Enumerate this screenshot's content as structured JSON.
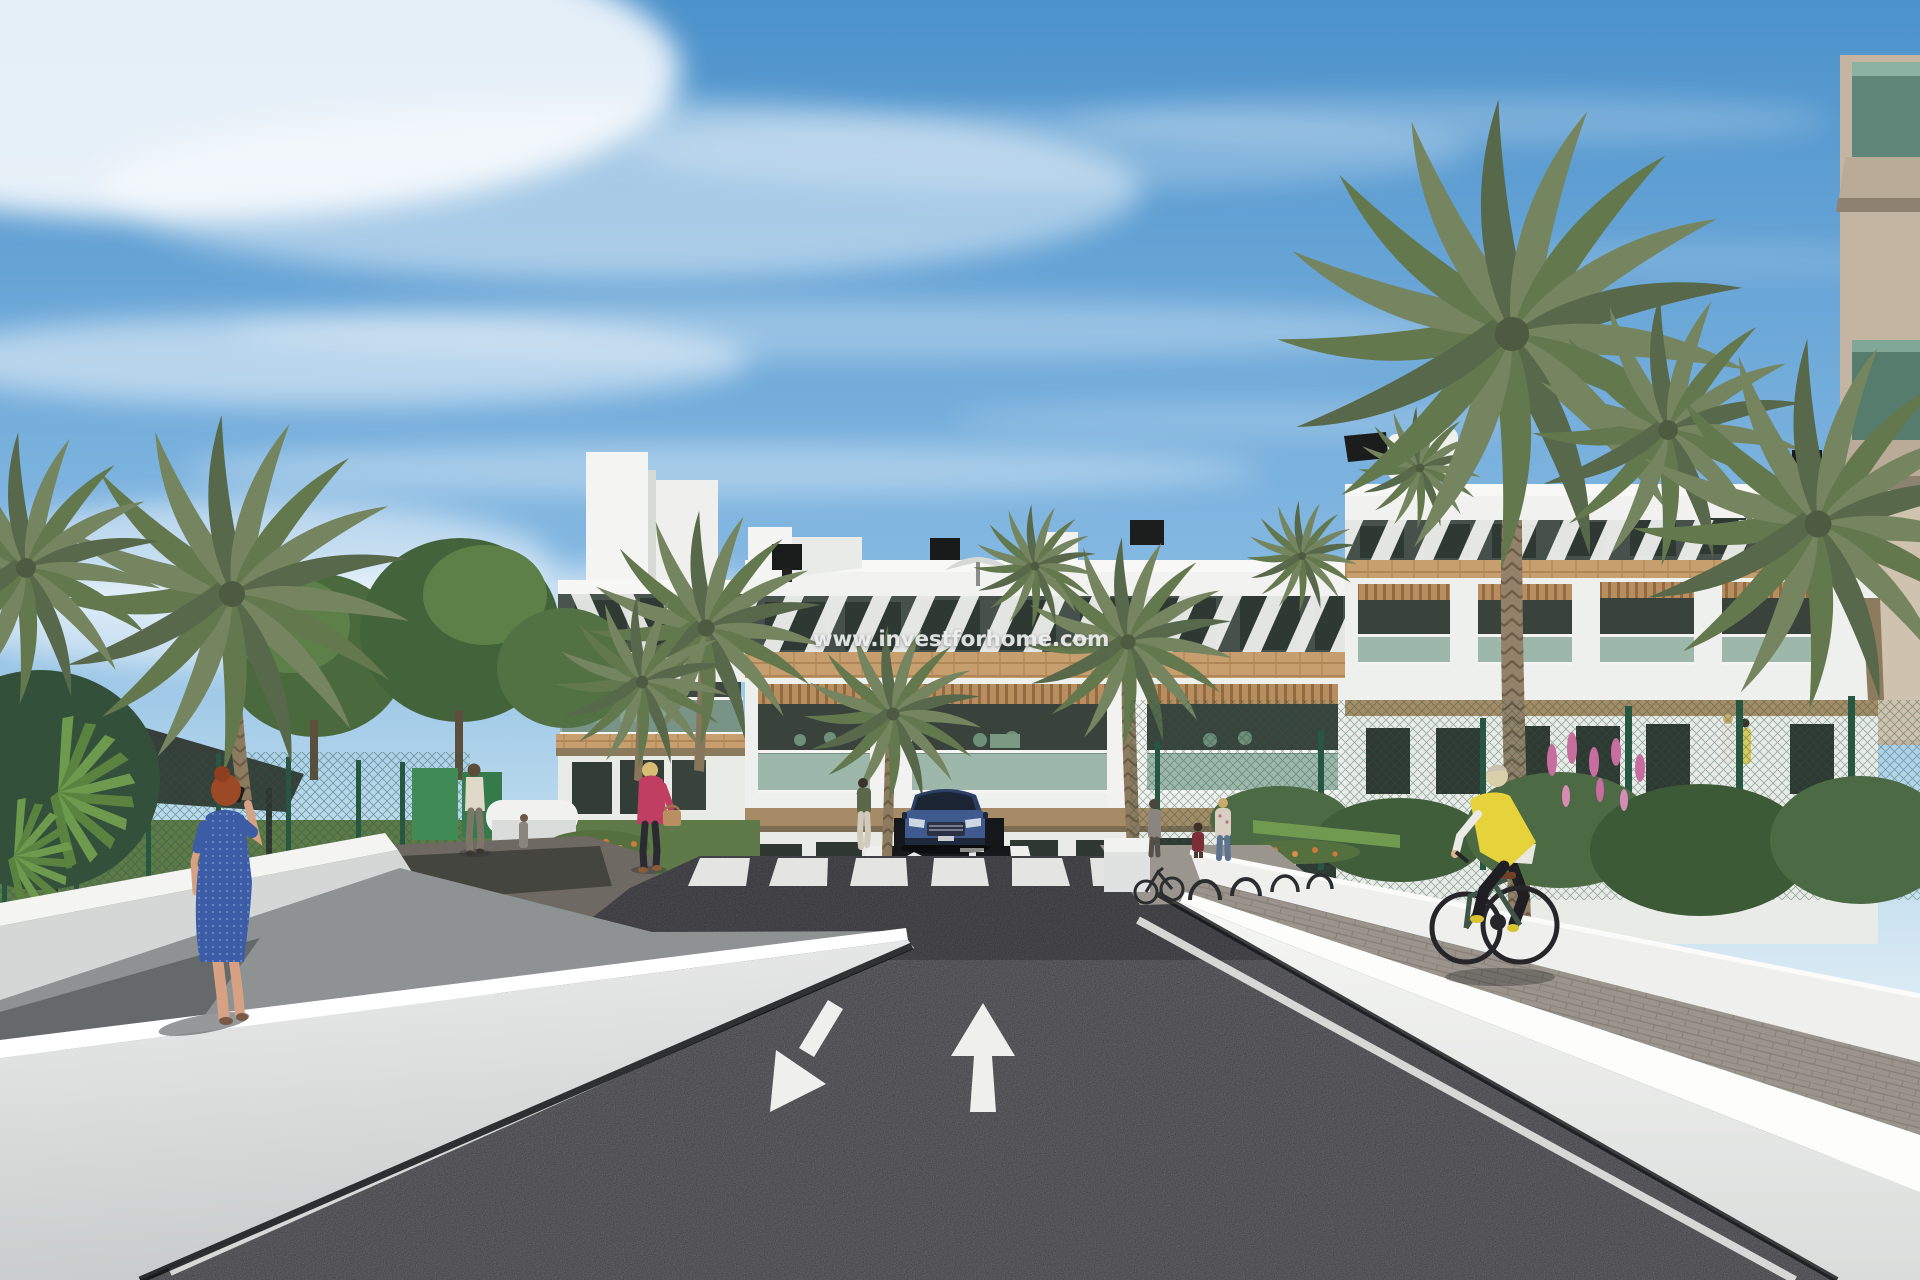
{
  "watermark": {
    "text": "www.investforhome.com",
    "color": "#eceded"
  },
  "scene": {
    "type": "3d-architectural-render",
    "setting": "New-build white Mediterranean apartment complex with palm trees, seen from a two-way asphalt access road",
    "sky": {
      "description": "blue sky with wispy white clouds",
      "top_color": "#4c92cb",
      "horizon_color": "#dcebf4"
    },
    "building": {
      "label": "white apartment block with wood accents",
      "wall_color": "#f2f3f0",
      "pergola_stripe_color": "#f3f4f2",
      "wood_band_color": "#c79e6d",
      "window_color": "#2e3933",
      "balcony_glass_color": "#86a898",
      "fascia_color": "#a58c66",
      "features": [
        "rooftop chimneys",
        "roof parasol",
        "diagonal pergola slats",
        "wood-clad band",
        "glass balconies",
        "garage ramp"
      ]
    },
    "road": {
      "surface_color": "#27272a",
      "marking_color": "#ededeb",
      "markings": [
        "large arrow pointing down-left",
        "large arrow pointing up",
        "zebra crosswalk",
        "white edge lines",
        "small ramp arrows"
      ]
    },
    "walls": {
      "color": "#f0f1ef",
      "description": "white boundary walls flanking road, walkway and cycle path"
    },
    "vehicles": [
      {
        "label": "dark blue SUV parked at garage ramp",
        "color": "#3e5a8e"
      },
      {
        "label": "dark green city bike ridden by cyclist",
        "color": "#3e5547"
      },
      {
        "label": "bicycles at bike racks",
        "color": "#2b2e31"
      }
    ],
    "people": [
      {
        "label": "woman in blue dress talking on phone",
        "dress_color": "#3c5ca6",
        "hair_color": "#9c4a26"
      },
      {
        "label": "man in white shirt walking away",
        "shirt_color": "#ded9c8"
      },
      {
        "label": "woman in pink jacket carrying handbag",
        "jacket_color": "#c13e63"
      },
      {
        "label": "woman standing by planter",
        "top_color": "#5c6648"
      },
      {
        "label": "woman with child and friend near bike racks"
      },
      {
        "label": "two residents on ground-floor terrace"
      },
      {
        "label": "cyclist in yellow vest",
        "vest_color": "#e6d23a"
      }
    ],
    "vegetation": {
      "palm_color": "#75855f",
      "tree_color": "#4a6a3e",
      "pink_flowers": "#c76da0",
      "orange_flowers": "#cd7a3a",
      "green_fence": "#2e5f48"
    }
  },
  "css_vars": {
    "--wm": "#eceded",
    "--asphalt": "#27272a",
    "--marking": "#ededeb",
    "--wood": "#c79e6d",
    "--glass": "#86a898",
    "--vest-yellow": "#e6d23a",
    "--dress-blue": "#3c5ca6",
    "--car-blue": "#3e5a8e",
    "--jacket-pink": "#c13e63"
  }
}
